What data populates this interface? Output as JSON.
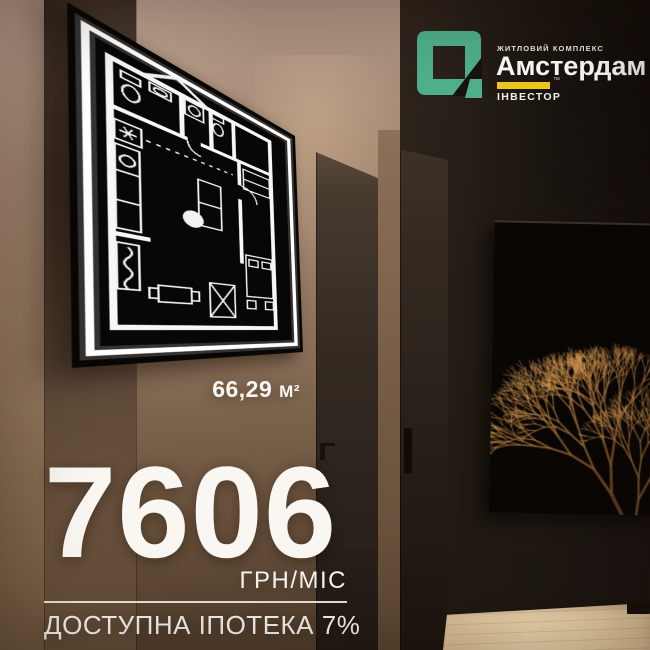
{
  "logo": {
    "estate_type": "ЖИТЛОВИЙ КОМПЛЕКС",
    "estate_name": "Амстердам",
    "developer": "ІНВЕСТОР",
    "trademark": "™",
    "colors": {
      "green": "#4fb08c",
      "yellow": "#eec61d"
    }
  },
  "floor_plan": {
    "area": "66,29",
    "area_unit": "М²"
  },
  "offer": {
    "price": "7606",
    "price_unit": "ГРН/МІС",
    "mortgage_note": "ДОСТУПНА ІПОТЕКА 7%"
  }
}
